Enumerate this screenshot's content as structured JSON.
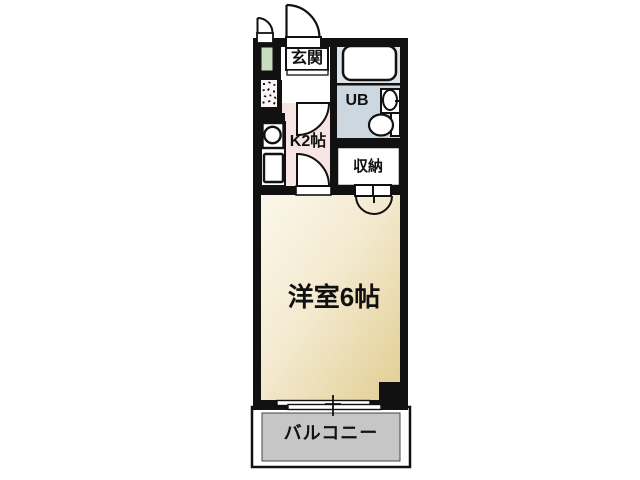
{
  "floorplan": {
    "rooms": {
      "entrance": {
        "label": "玄関"
      },
      "unit_bath": {
        "label": "UB"
      },
      "kitchen": {
        "label": "K2帖"
      },
      "storage": {
        "label": "収納"
      },
      "main_room": {
        "label": "洋室6帖"
      },
      "balcony": {
        "label": "バルコニー"
      }
    },
    "fixtures": [
      "entrance-door",
      "cabinet-door",
      "shoe-cabinet",
      "washer-space",
      "stove",
      "kitchen-sink",
      "bathtub",
      "wash-basin",
      "toilet",
      "kitchen-entry-door",
      "room-entry-door",
      "closet-double-doors",
      "sliding-window",
      "pillar"
    ],
    "colors": {
      "wall": "#111111",
      "kitchen_floor": "#f7e5e3",
      "washer_space": "#fdf5f5",
      "shoe_cabinet": "#c8dcc0",
      "unit_bath_floor": "#ccd7df",
      "bath_surround": "#dde4e9",
      "room_gradient_start": "#fbf7ea",
      "room_gradient_end": "#e2cd92",
      "balcony_floor": "#c6c6c6"
    }
  }
}
